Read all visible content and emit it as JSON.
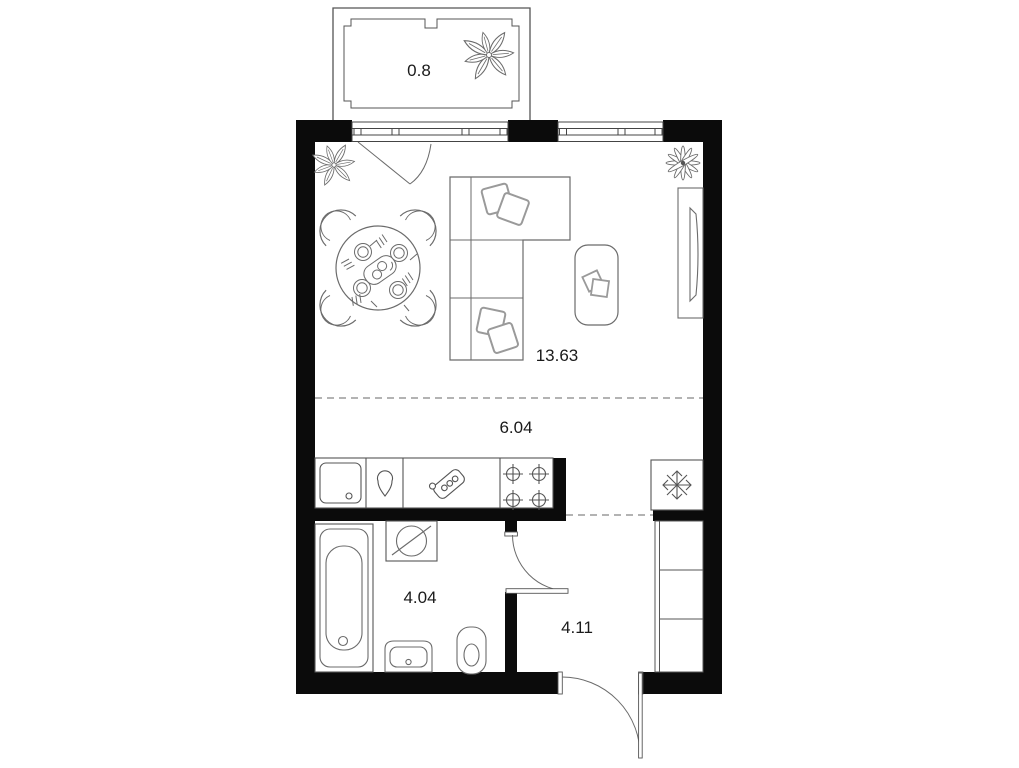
{
  "plan": {
    "rooms": [
      {
        "id": "balcony",
        "area": "0.8"
      },
      {
        "id": "living-room",
        "area": "13.63"
      },
      {
        "id": "kitchen",
        "area": "6.04"
      },
      {
        "id": "bathroom",
        "area": "4.04"
      },
      {
        "id": "hallway",
        "area": "4.11"
      }
    ],
    "colors": {
      "background": "#ffffff",
      "wall": "#0b0b0b",
      "structure_line": "#555555",
      "furniture_line": "#6b6b6b",
      "soft_line": "#999999",
      "dashed_divider": "#9a9a9a",
      "label_text": "#1a1a1a"
    },
    "icons": [
      "balcony-plant-icon",
      "plant-icon",
      "flower-icon",
      "dining-table-icon",
      "chair-icon",
      "plate-icon",
      "corner-sofa-icon",
      "pillow-icon",
      "coffee-table-icon",
      "book-icon",
      "tv-stand-icon",
      "tv-icon",
      "kitchen-sink-icon",
      "tap-drop-icon",
      "cutting-board-icon",
      "stove-burners-icon",
      "fridge-snowflake-icon",
      "bathtub-icon",
      "washing-machine-icon",
      "washbasin-icon",
      "toilet-icon",
      "wardrobe-icon",
      "door-swing-icon",
      "window-icon"
    ]
  }
}
